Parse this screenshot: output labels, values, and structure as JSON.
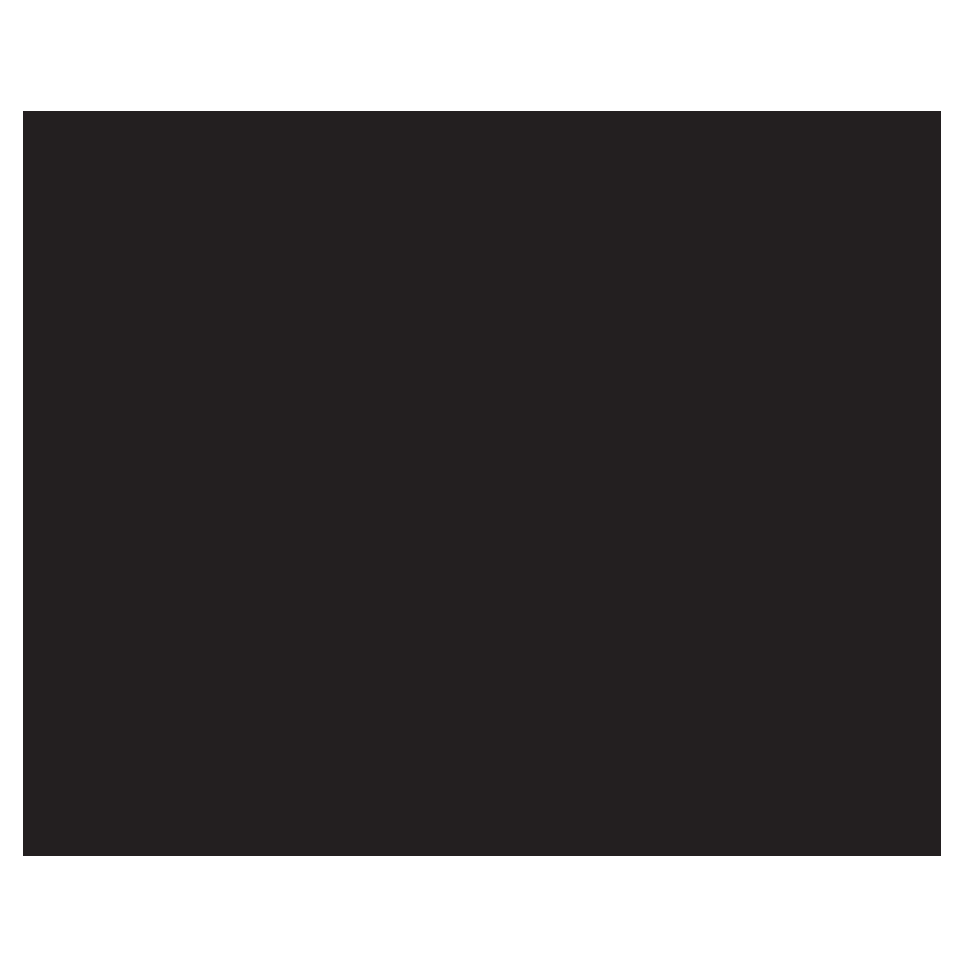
{
  "canvas": {
    "background_color": "#ffffff"
  },
  "screen": {
    "fill_color": "#231f20",
    "visible_text": "",
    "state_note": "blank-dark-screen"
  }
}
